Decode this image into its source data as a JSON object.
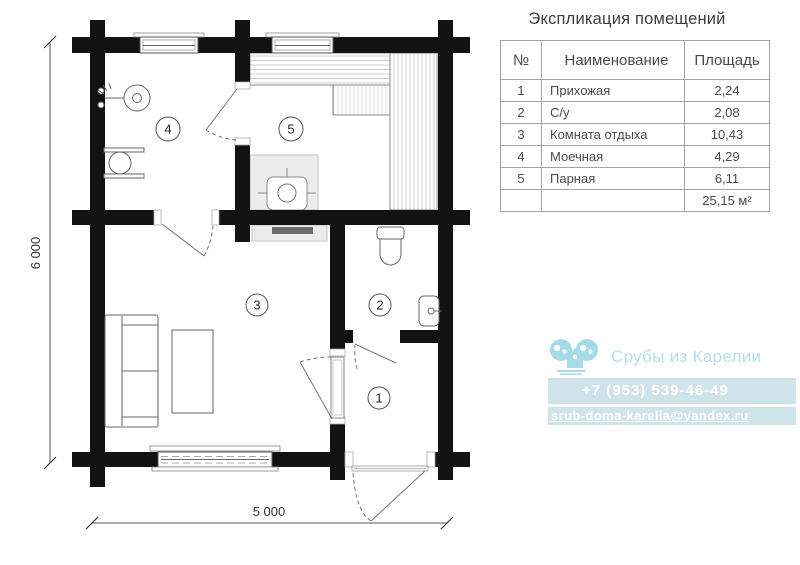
{
  "plan": {
    "room_labels": {
      "r1": "1",
      "r2": "2",
      "r3": "3",
      "r4": "4",
      "r5": "5"
    },
    "dim_vertical": "6 000",
    "dim_horizontal": "5 000"
  },
  "table": {
    "title": "Экспликация помещений",
    "headers": {
      "num": "№",
      "name": "Наименование",
      "area": "Площадь"
    },
    "rows": [
      {
        "num": "1",
        "name": "Прихожая",
        "area": "2,24"
      },
      {
        "num": "2",
        "name": "С/у",
        "area": "2,08"
      },
      {
        "num": "3",
        "name": "Комната отдыха",
        "area": "10,43"
      },
      {
        "num": "4",
        "name": "Моечная",
        "area": "4,29"
      },
      {
        "num": "5",
        "name": "Парная",
        "area": "6,11"
      }
    ],
    "total": "25,15 м²"
  },
  "brand": {
    "name": "Срубы из Карелии",
    "phone": "+7 (953) 539-46-49",
    "email": "srub-doma-karelia@yandex.ru",
    "accent": "#a5dbe7",
    "band": "#cfe3eb"
  }
}
